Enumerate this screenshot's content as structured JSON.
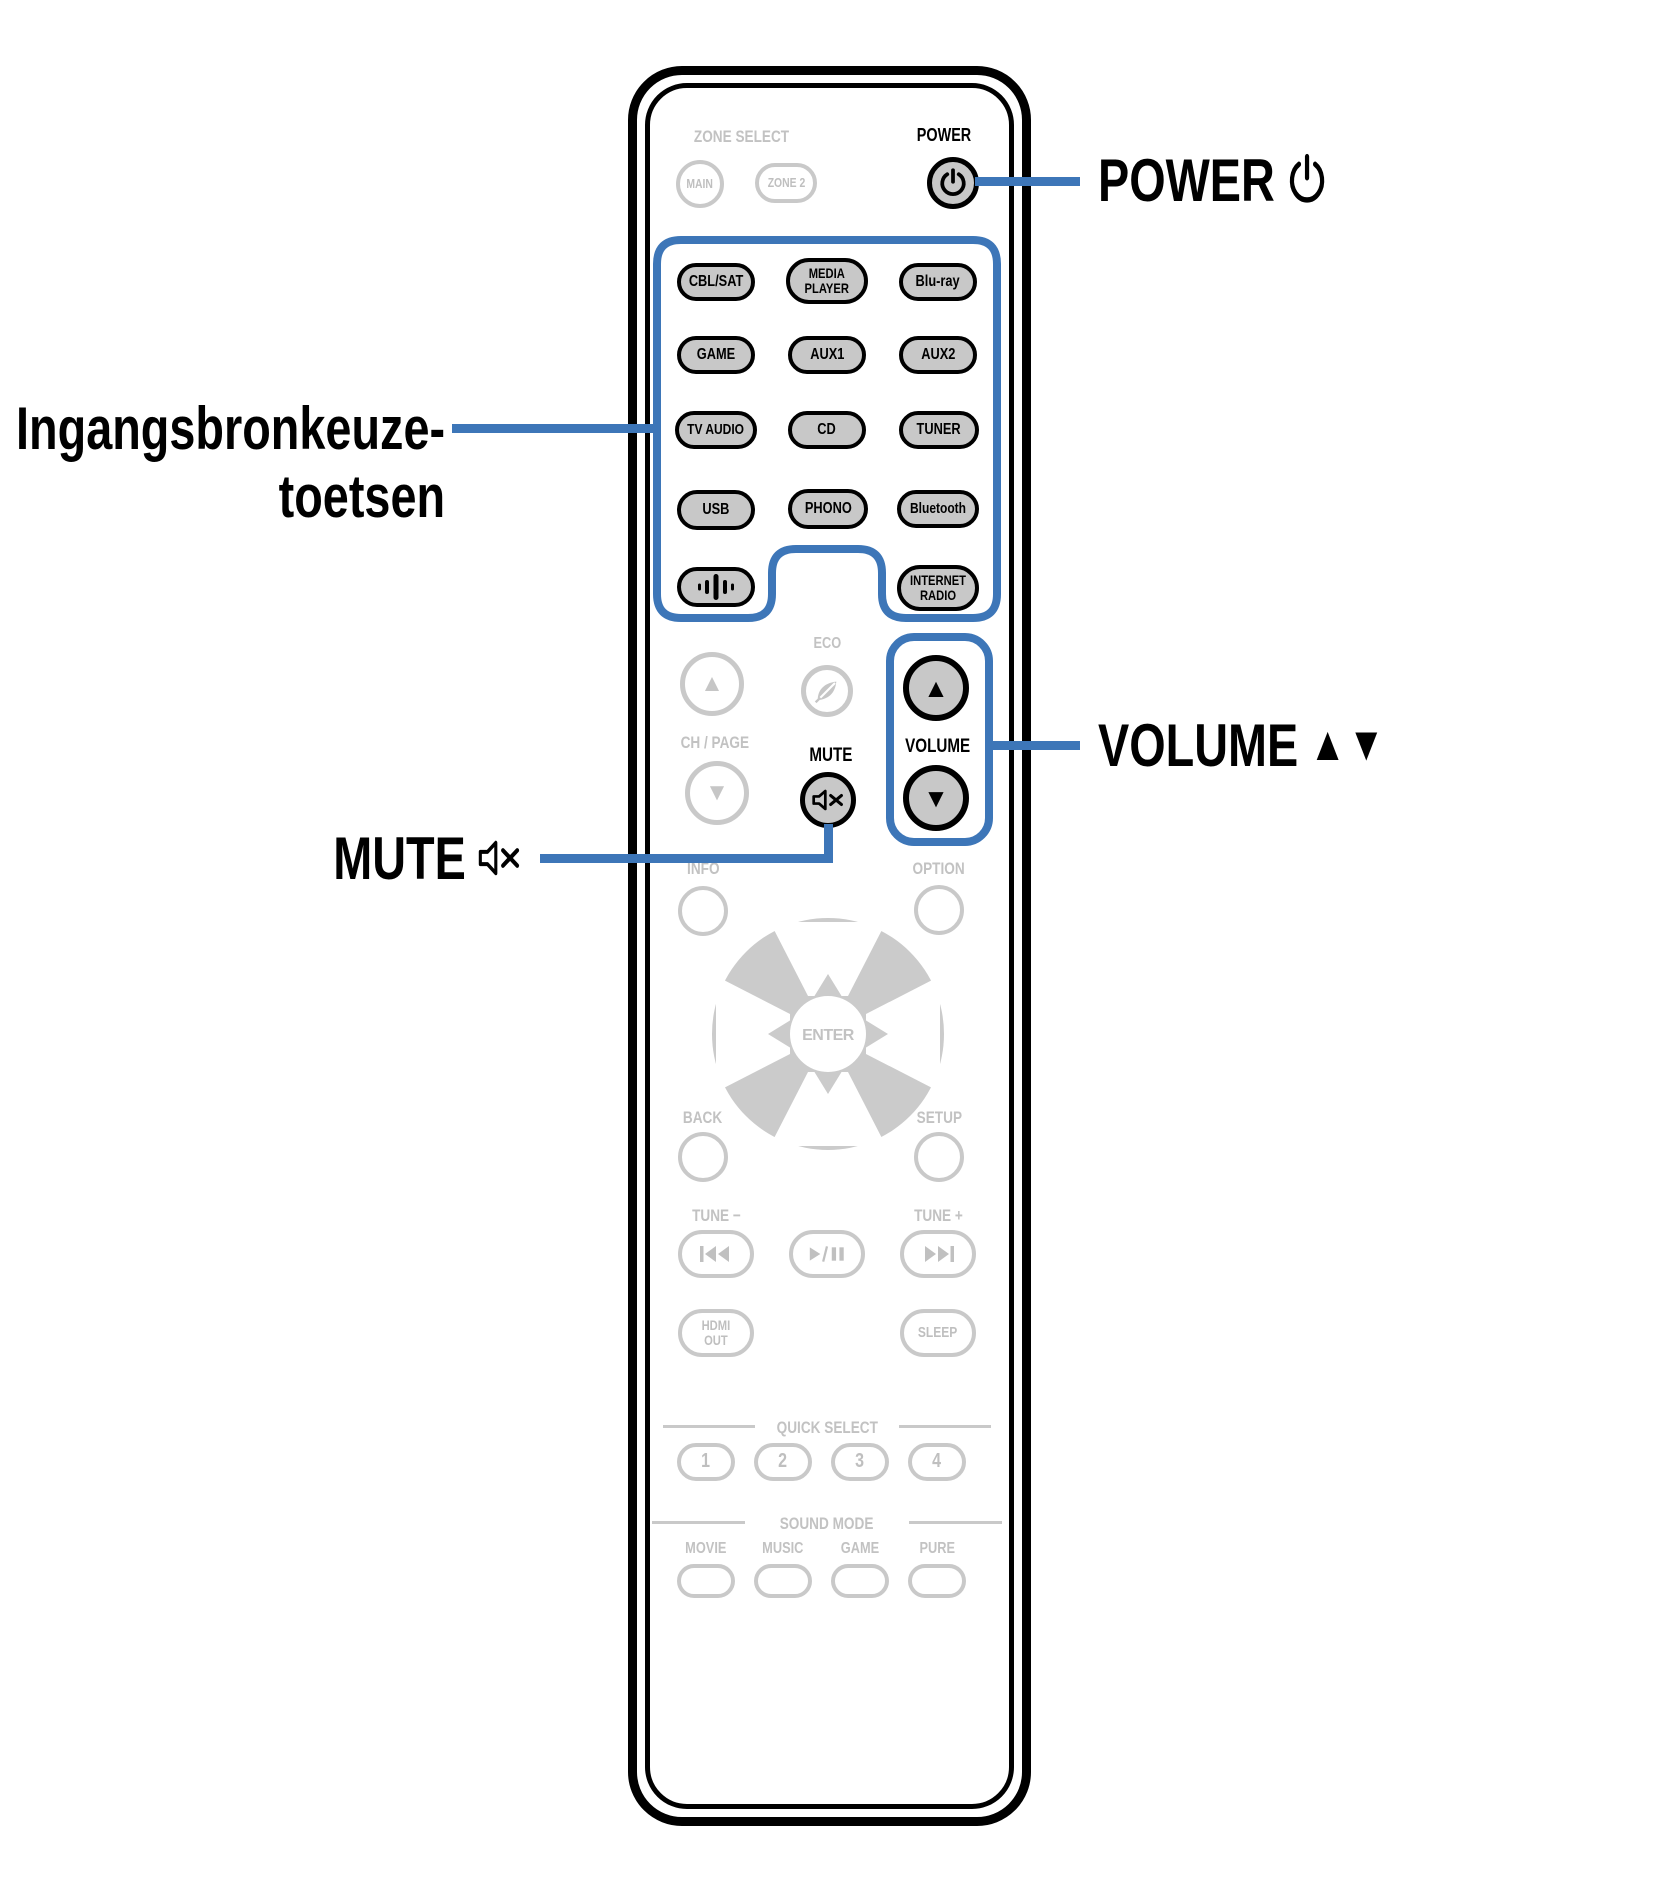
{
  "colors": {
    "accent_blue": "#3d76b8",
    "button_fill_gray": "#c8c8c8",
    "inactive_outline_gray": "#c9c9c9",
    "inactive_text_gray": "#bfbfbf",
    "active_outline_black": "#000000"
  },
  "callouts": {
    "power": {
      "label": "POWER",
      "icon": "power-icon"
    },
    "input_sources": {
      "line1": "Ingangsbronkeuze-",
      "line2": "toetsen"
    },
    "volume": {
      "label": "VOLUME",
      "up_icon": "▲",
      "down_icon": "▼"
    },
    "mute": {
      "label": "MUTE",
      "icon": "mute-icon"
    }
  },
  "remote": {
    "zone_select": {
      "title": "ZONE SELECT",
      "main": "MAIN",
      "zone2": "ZONE 2"
    },
    "power": {
      "label": "POWER"
    },
    "sources": [
      {
        "label": "CBL/SAT"
      },
      {
        "label": "MEDIA\nPLAYER"
      },
      {
        "label": "Blu-ray"
      },
      {
        "label": "GAME"
      },
      {
        "label": "AUX1"
      },
      {
        "label": "AUX2"
      },
      {
        "label": "TV AUDIO"
      },
      {
        "label": "CD"
      },
      {
        "label": "TUNER"
      },
      {
        "label": "USB"
      },
      {
        "label": "PHONO"
      },
      {
        "label": "Bluetooth"
      },
      {
        "label": "",
        "icon": "audio-signal-icon"
      },
      {
        "label": "INTERNET\nRADIO"
      }
    ],
    "eco": {
      "label": "ECO",
      "icon": "eco-leaf-icon"
    },
    "ch_page": {
      "label": "CH / PAGE",
      "up_icon": "▲",
      "down_icon": "▼"
    },
    "mute": {
      "label": "MUTE",
      "icon": "mute-icon"
    },
    "volume": {
      "label": "VOLUME",
      "up_icon": "▲",
      "down_icon": "▼"
    },
    "info": {
      "label": "INFO"
    },
    "option": {
      "label": "OPTION"
    },
    "nav": {
      "enter": "ENTER"
    },
    "back": {
      "label": "BACK"
    },
    "setup": {
      "label": "SETUP"
    },
    "tune_down": "TUNE −",
    "tune_up": "TUNE +",
    "hdmi_out": "HDMI\nOUT",
    "sleep": "SLEEP",
    "quick_select": {
      "title": "QUICK SELECT",
      "buttons": [
        "1",
        "2",
        "3",
        "4"
      ]
    },
    "sound_mode": {
      "title": "SOUND MODE",
      "modes": [
        "MOVIE",
        "MUSIC",
        "GAME",
        "PURE"
      ]
    }
  }
}
